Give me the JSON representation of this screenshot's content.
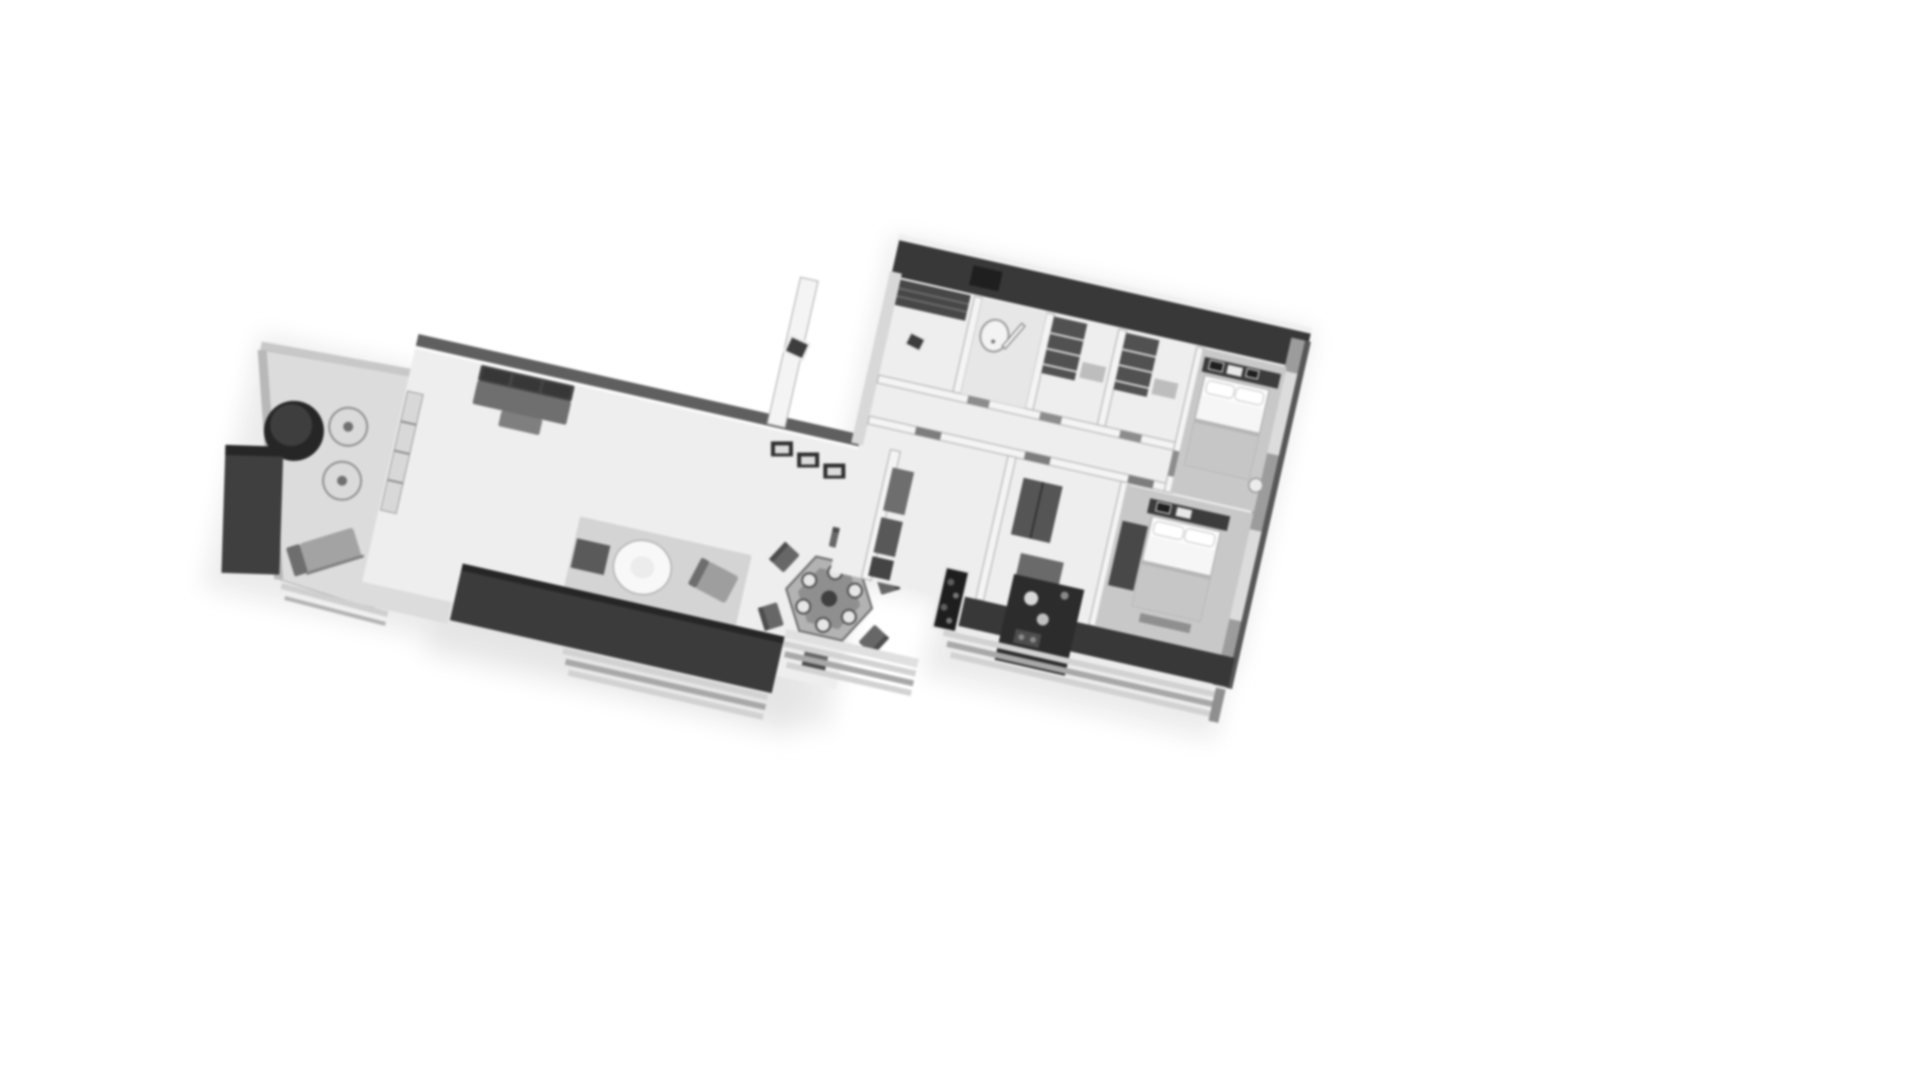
{
  "meta": {
    "description": "Grayscale 3D isometric dollhouse-view floor plan render of an apartment on a plain white background",
    "render_style": "soft blurred grayscale architectural visualization",
    "rotation_deg": 12.8,
    "canvas": {
      "width": 1920,
      "height": 1080
    }
  },
  "palette": {
    "bg": "#ffffff",
    "floor": "#eeeeee",
    "floor_dim": "#dcdcdc",
    "floor_shade": "#c8c8c8",
    "wall_dark": "#383838",
    "wall_mid": "#9c9c9c",
    "wall_white": "#f4f4f4",
    "wall_edge": "#b7b7b7",
    "furn_black": "#262626",
    "furn_dark": "#4a4a4a",
    "furn_mid": "#6f6f6f",
    "furn_light": "#cbcbcb",
    "bed_linen": "#f6f6f6",
    "blanket": "#c6c6c6",
    "rail_light": "#d2d2d2",
    "rail_dark": "#a8a8a8",
    "halo": "#e2e2e2"
  },
  "scene": {
    "rooms": [
      "terrace",
      "living-room",
      "dining-area",
      "hallway",
      "kitchen",
      "utility-room",
      "bathroom",
      "closet-room-1",
      "closet-room-2",
      "bedroom-1",
      "bedroom-2",
      "lower-room-1",
      "lower-room-2",
      "balcony"
    ],
    "furniture_icons": [
      "terrace-round-table",
      "terrace-chair",
      "lounge-chair",
      "planter-box",
      "sofa",
      "wall-frame",
      "area-rug",
      "side-table",
      "round-coffee-table",
      "armchair",
      "hexagonal-dining-table",
      "dining-chair",
      "kitchen-counter",
      "plant-niche",
      "hall-cabinet",
      "shelf-unit",
      "wardrobe",
      "desk",
      "sink",
      "door-leaf",
      "double-bed",
      "pillow",
      "night-stool",
      "balcony-railing"
    ]
  }
}
